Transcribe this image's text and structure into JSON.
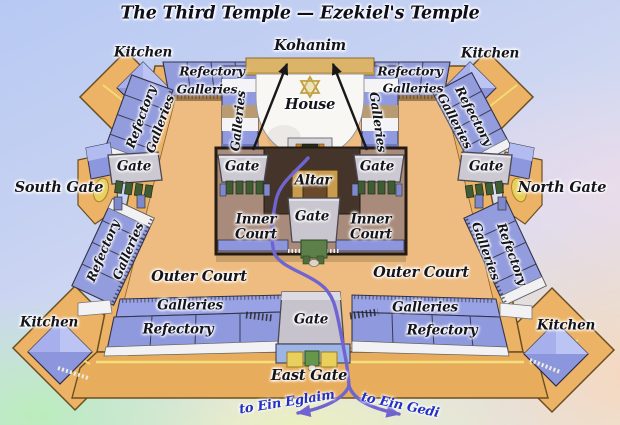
{
  "title": "The Third Temple — Ezekiel's Temple",
  "diagram": {
    "kohanim": "Kohanim",
    "kitchen": "Kitchen",
    "refectory": "Refectory",
    "galleries": "Galleries",
    "house": "House",
    "altar": "Altar",
    "gate": "Gate",
    "south_gate": "South Gate",
    "north_gate": "North Gate",
    "east_gate": "East Gate",
    "inner_court": "Inner Court",
    "outer_court": "Outer Court",
    "river_left": "to Ein Eglaim",
    "river_right": "to Ein Gedi"
  },
  "colors": {
    "platform_tan": "#ecb265",
    "court_floor": "#eebc80",
    "building_periwinkle": "#8f99de",
    "inner_court_floor": "#a98b7b",
    "altar_yard": "#453429",
    "altar_block": "#c79c4e",
    "gate_plaque": "#ccc9d2",
    "river": "#7064d0",
    "river_label_blue": "#2330c6",
    "star_gold": "#c2a041"
  }
}
